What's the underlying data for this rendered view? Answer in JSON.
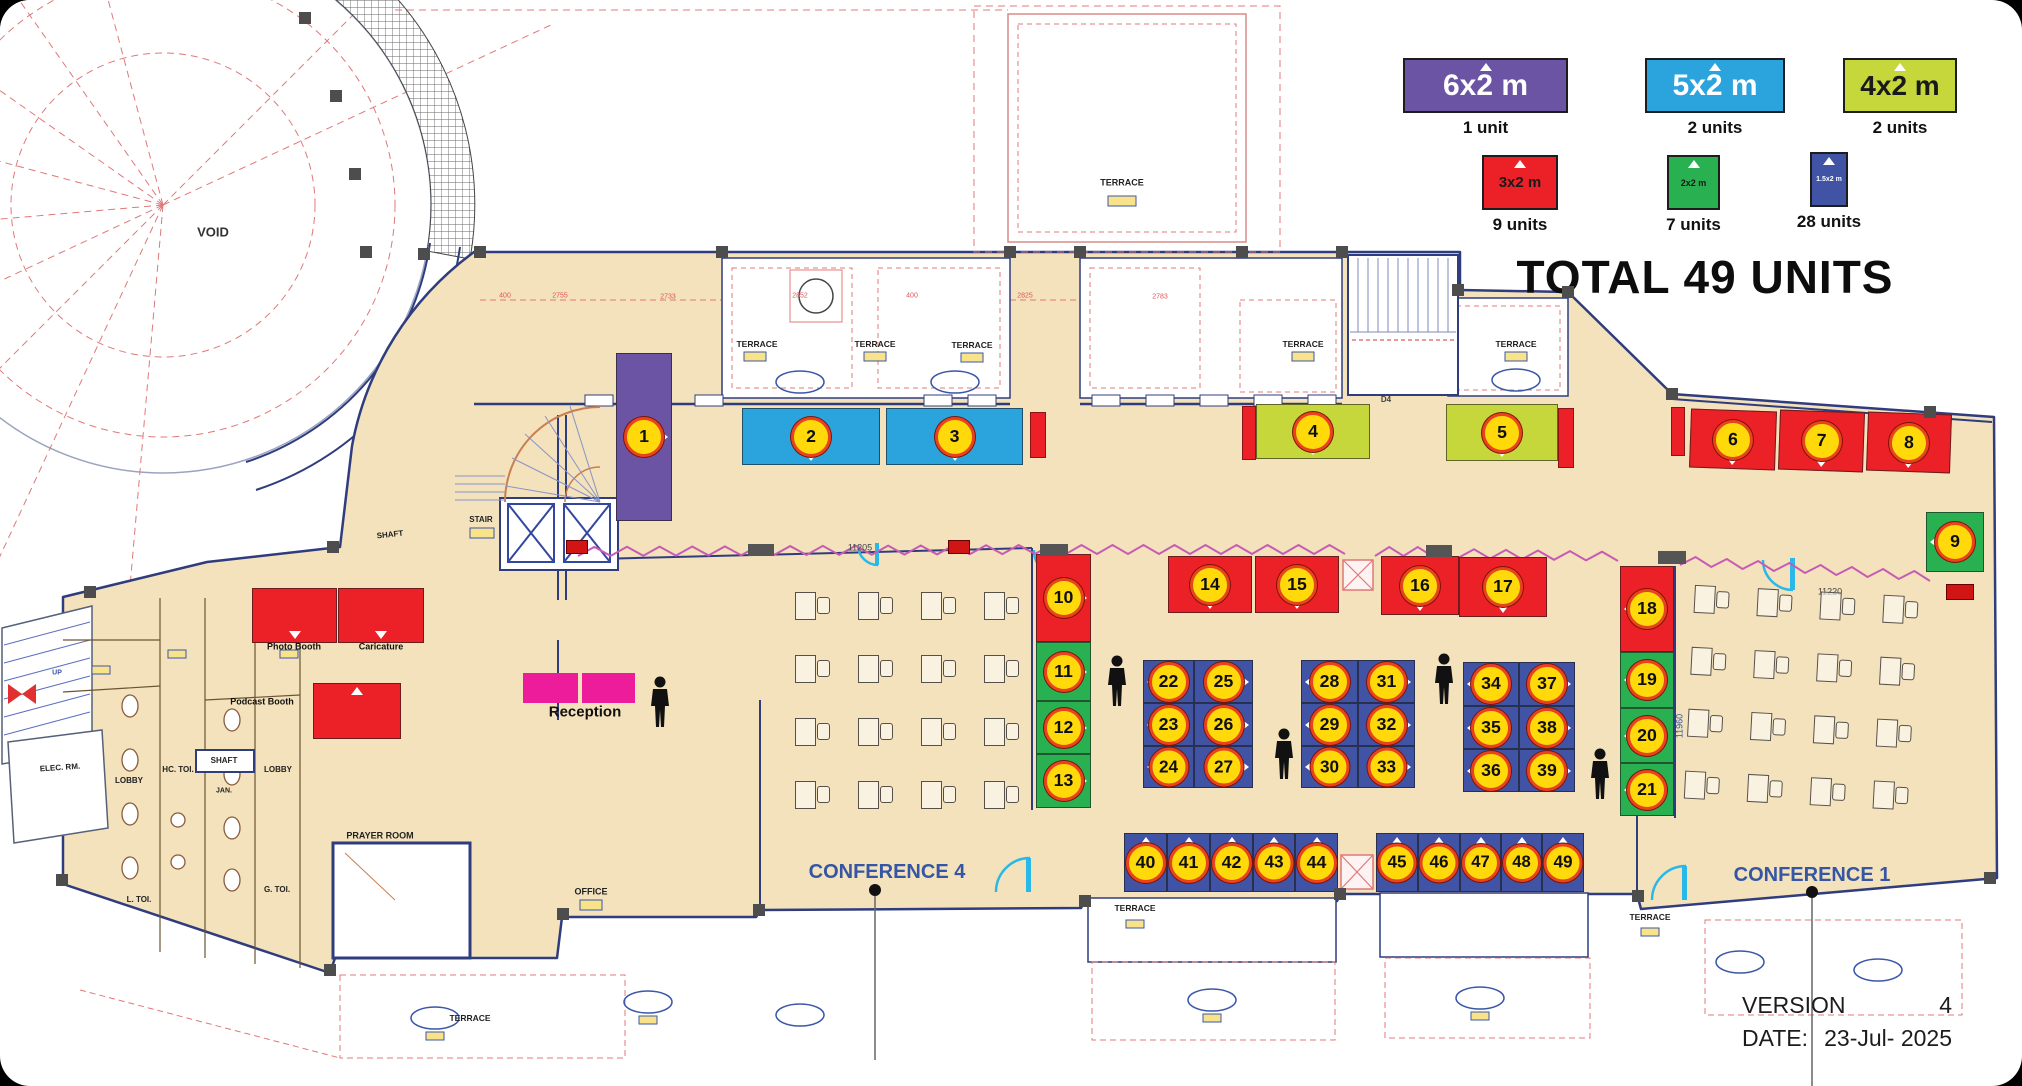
{
  "title": {
    "total": "TOTAL 49 UNITS",
    "version_label": "VERSION",
    "version_value": "4",
    "date_label": "DATE:",
    "date_value": "23-Jul- 2025"
  },
  "legend": {
    "items": [
      {
        "label": "6x2 m",
        "units": "1 unit",
        "color": "#6A54A3",
        "fg": "#ffffff",
        "x": 1403,
        "y": 58,
        "w": 165,
        "h": 55,
        "fs": 30
      },
      {
        "label": "5x2 m",
        "units": "2 units",
        "color": "#2BA4DD",
        "fg": "#ffffff",
        "x": 1645,
        "y": 58,
        "w": 140,
        "h": 55,
        "fs": 30
      },
      {
        "label": "4x2 m",
        "units": "2 units",
        "color": "#C5D73B",
        "fg": "#1a1a1a",
        "x": 1843,
        "y": 58,
        "w": 114,
        "h": 55,
        "fs": 28
      },
      {
        "label": "3x2 m",
        "units": "9 units",
        "color": "#EB2127",
        "fg": "#1a1a1a",
        "x": 1482,
        "y": 155,
        "w": 76,
        "h": 55,
        "fs": 15
      },
      {
        "label": "2x2 m",
        "units": "7 units",
        "color": "#29B050",
        "fg": "#1a1a1a",
        "x": 1667,
        "y": 155,
        "w": 53,
        "h": 55,
        "fs": 9
      },
      {
        "label": "1.5x2 m",
        "units": "28 units",
        "color": "#4053A4",
        "fg": "#ffffff",
        "x": 1810,
        "y": 152,
        "w": 38,
        "h": 55,
        "fs": 7
      }
    ]
  },
  "booths": [
    {
      "n": "1",
      "x": 616,
      "y": 353,
      "w": 56,
      "h": 168,
      "type": "purple",
      "dir": "right"
    },
    {
      "n": "2",
      "x": 742,
      "y": 408,
      "w": 138,
      "h": 57,
      "type": "blue",
      "dir": "down"
    },
    {
      "n": "3",
      "x": 886,
      "y": 408,
      "w": 137,
      "h": 57,
      "type": "blue",
      "dir": "down"
    },
    {
      "n": "4",
      "x": 1256,
      "y": 404,
      "w": 114,
      "h": 55,
      "type": "yg",
      "dir": "down"
    },
    {
      "n": "5",
      "x": 1446,
      "y": 404,
      "w": 112,
      "h": 57,
      "type": "yg",
      "dir": "down"
    },
    {
      "n": "6",
      "x": 1690,
      "y": 410,
      "w": 86,
      "h": 59,
      "type": "red",
      "dir": "down",
      "rot": 2
    },
    {
      "n": "7",
      "x": 1779,
      "y": 411,
      "w": 85,
      "h": 60,
      "type": "red",
      "dir": "down",
      "rot": 2
    },
    {
      "n": "8",
      "x": 1867,
      "y": 413,
      "w": 84,
      "h": 59,
      "type": "red",
      "dir": "down",
      "rot": 2
    },
    {
      "n": "9",
      "x": 1926,
      "y": 512,
      "w": 58,
      "h": 60,
      "type": "green",
      "dir": "left"
    },
    {
      "n": "10",
      "x": 1036,
      "y": 554,
      "w": 55,
      "h": 88,
      "type": "red",
      "dir": "right"
    },
    {
      "n": "11",
      "x": 1036,
      "y": 642,
      "w": 55,
      "h": 59,
      "type": "green",
      "dir": "right"
    },
    {
      "n": "12",
      "x": 1036,
      "y": 701,
      "w": 55,
      "h": 53,
      "type": "green",
      "dir": "right"
    },
    {
      "n": "13",
      "x": 1036,
      "y": 754,
      "w": 55,
      "h": 54,
      "type": "green",
      "dir": "right"
    },
    {
      "n": "14",
      "x": 1168,
      "y": 556,
      "w": 84,
      "h": 57,
      "type": "red",
      "dir": "down"
    },
    {
      "n": "15",
      "x": 1255,
      "y": 556,
      "w": 84,
      "h": 57,
      "type": "red",
      "dir": "down"
    },
    {
      "n": "16",
      "x": 1381,
      "y": 556,
      "w": 78,
      "h": 59,
      "type": "red",
      "dir": "down"
    },
    {
      "n": "17",
      "x": 1459,
      "y": 557,
      "w": 88,
      "h": 60,
      "type": "red",
      "dir": "down"
    },
    {
      "n": "18",
      "x": 1620,
      "y": 566,
      "w": 54,
      "h": 86,
      "type": "red",
      "dir": "left"
    },
    {
      "n": "19",
      "x": 1620,
      "y": 652,
      "w": 54,
      "h": 56,
      "type": "green",
      "dir": "left"
    },
    {
      "n": "20",
      "x": 1620,
      "y": 708,
      "w": 54,
      "h": 55,
      "type": "green",
      "dir": "left"
    },
    {
      "n": "21",
      "x": 1620,
      "y": 763,
      "w": 54,
      "h": 53,
      "type": "green",
      "dir": "left"
    },
    {
      "n": "22",
      "x": 1143,
      "y": 660,
      "w": 51,
      "h": 43,
      "type": "indigo",
      "dir": "left"
    },
    {
      "n": "25",
      "x": 1194,
      "y": 660,
      "w": 59,
      "h": 43,
      "type": "indigo",
      "dir": "right"
    },
    {
      "n": "23",
      "x": 1143,
      "y": 703,
      "w": 51,
      "h": 43,
      "type": "indigo",
      "dir": "left"
    },
    {
      "n": "26",
      "x": 1194,
      "y": 703,
      "w": 59,
      "h": 43,
      "type": "indigo",
      "dir": "right"
    },
    {
      "n": "24",
      "x": 1143,
      "y": 746,
      "w": 51,
      "h": 42,
      "type": "indigo",
      "dir": "left"
    },
    {
      "n": "27",
      "x": 1194,
      "y": 746,
      "w": 59,
      "h": 42,
      "type": "indigo",
      "dir": "right"
    },
    {
      "n": "28",
      "x": 1301,
      "y": 660,
      "w": 57,
      "h": 43,
      "type": "indigo",
      "dir": "left"
    },
    {
      "n": "31",
      "x": 1358,
      "y": 660,
      "w": 57,
      "h": 43,
      "type": "indigo",
      "dir": "right"
    },
    {
      "n": "29",
      "x": 1301,
      "y": 703,
      "w": 57,
      "h": 43,
      "type": "indigo",
      "dir": "left"
    },
    {
      "n": "32",
      "x": 1358,
      "y": 703,
      "w": 57,
      "h": 43,
      "type": "indigo",
      "dir": "right"
    },
    {
      "n": "30",
      "x": 1301,
      "y": 746,
      "w": 57,
      "h": 42,
      "type": "indigo",
      "dir": "left"
    },
    {
      "n": "33",
      "x": 1358,
      "y": 746,
      "w": 57,
      "h": 42,
      "type": "indigo",
      "dir": "right"
    },
    {
      "n": "34",
      "x": 1463,
      "y": 662,
      "w": 56,
      "h": 44,
      "type": "indigo",
      "dir": "left"
    },
    {
      "n": "37",
      "x": 1519,
      "y": 662,
      "w": 56,
      "h": 44,
      "type": "indigo",
      "dir": "right"
    },
    {
      "n": "35",
      "x": 1463,
      "y": 706,
      "w": 56,
      "h": 43,
      "type": "indigo",
      "dir": "left"
    },
    {
      "n": "38",
      "x": 1519,
      "y": 706,
      "w": 56,
      "h": 43,
      "type": "indigo",
      "dir": "right"
    },
    {
      "n": "36",
      "x": 1463,
      "y": 749,
      "w": 56,
      "h": 43,
      "type": "indigo",
      "dir": "left"
    },
    {
      "n": "39",
      "x": 1519,
      "y": 749,
      "w": 56,
      "h": 43,
      "type": "indigo",
      "dir": "right"
    },
    {
      "n": "40",
      "x": 1124,
      "y": 833,
      "w": 43,
      "h": 59,
      "type": "indigo",
      "dir": "up"
    },
    {
      "n": "41",
      "x": 1167,
      "y": 833,
      "w": 43,
      "h": 59,
      "type": "indigo",
      "dir": "up"
    },
    {
      "n": "42",
      "x": 1210,
      "y": 833,
      "w": 43,
      "h": 59,
      "type": "indigo",
      "dir": "up"
    },
    {
      "n": "43",
      "x": 1253,
      "y": 833,
      "w": 42,
      "h": 59,
      "type": "indigo",
      "dir": "up"
    },
    {
      "n": "44",
      "x": 1295,
      "y": 833,
      "w": 43,
      "h": 59,
      "type": "indigo",
      "dir": "up"
    },
    {
      "n": "45",
      "x": 1376,
      "y": 833,
      "w": 42,
      "h": 59,
      "type": "indigo",
      "dir": "up"
    },
    {
      "n": "46",
      "x": 1418,
      "y": 833,
      "w": 42,
      "h": 59,
      "type": "indigo",
      "dir": "up"
    },
    {
      "n": "47",
      "x": 1460,
      "y": 833,
      "w": 41,
      "h": 59,
      "type": "indigo",
      "dir": "up"
    },
    {
      "n": "48",
      "x": 1501,
      "y": 833,
      "w": 41,
      "h": 59,
      "type": "indigo",
      "dir": "up"
    },
    {
      "n": "49",
      "x": 1542,
      "y": 833,
      "w": 42,
      "h": 59,
      "type": "indigo",
      "dir": "up"
    },
    {
      "n": "",
      "x": 252,
      "y": 588,
      "w": 85,
      "h": 55,
      "type": "red",
      "dir": "down"
    },
    {
      "n": "",
      "x": 338,
      "y": 588,
      "w": 86,
      "h": 55,
      "type": "red",
      "dir": "down"
    },
    {
      "n": "",
      "x": 313,
      "y": 683,
      "w": 88,
      "h": 56,
      "type": "red",
      "dir": "up"
    }
  ],
  "map_labels": [
    {
      "name": "void-label",
      "t": "VOID",
      "x": 213,
      "y": 232,
      "fs": 13,
      "c": "#333",
      "fw": 600
    },
    {
      "name": "terrace-label",
      "t": "TERRACE",
      "x": 757,
      "y": 344,
      "fs": 8.5,
      "c": "#222",
      "fw": 600
    },
    {
      "name": "terrace-label",
      "t": "TERRACE",
      "x": 875,
      "y": 344,
      "fs": 8.5,
      "c": "#222",
      "fw": 600
    },
    {
      "name": "terrace-label",
      "t": "TERRACE",
      "x": 972,
      "y": 345,
      "fs": 8.5,
      "c": "#222",
      "fw": 600
    },
    {
      "name": "terrace-label",
      "t": "TERRACE",
      "x": 1303,
      "y": 344,
      "fs": 8.5,
      "c": "#222",
      "fw": 600
    },
    {
      "name": "terrace-label",
      "t": "TERRACE",
      "x": 1516,
      "y": 344,
      "fs": 8.5,
      "c": "#222",
      "fw": 600
    },
    {
      "name": "terrace-label",
      "t": "TERRACE",
      "x": 1122,
      "y": 183,
      "fs": 9,
      "c": "#222",
      "fw": 600
    },
    {
      "name": "terrace-label",
      "t": "TERRACE",
      "x": 1135,
      "y": 908,
      "fs": 8.5,
      "c": "#222",
      "fw": 600
    },
    {
      "name": "terrace-label",
      "t": "TERRACE",
      "x": 1650,
      "y": 917,
      "fs": 8.5,
      "c": "#222",
      "fw": 600
    },
    {
      "name": "terrace-label",
      "t": "TERRACE",
      "x": 470,
      "y": 1018,
      "fs": 8.5,
      "c": "#222",
      "fw": 600
    },
    {
      "name": "stair-label",
      "t": "STAIR",
      "x": 481,
      "y": 520,
      "fs": 8,
      "c": "#222",
      "fw": 600
    },
    {
      "name": "shaft-label",
      "t": "SHAFT",
      "x": 390,
      "y": 535,
      "fs": 8,
      "c": "#222",
      "fw": 600,
      "rot": -6
    },
    {
      "name": "shaft-label",
      "t": "SHAFT",
      "x": 224,
      "y": 761,
      "fs": 8,
      "c": "#222",
      "fw": 600
    },
    {
      "name": "elec-room-label",
      "t": "ELEC. RM.",
      "x": 60,
      "y": 768,
      "fs": 8,
      "c": "#222",
      "fw": 600,
      "rot": -4
    },
    {
      "name": "lobby-label",
      "t": "LOBBY",
      "x": 129,
      "y": 781,
      "fs": 8,
      "c": "#222",
      "fw": 600
    },
    {
      "name": "hc-toilet-label",
      "t": "HC. TOI.",
      "x": 178,
      "y": 770,
      "fs": 8,
      "c": "#222",
      "fw": 600
    },
    {
      "name": "janitor-label",
      "t": "JAN.",
      "x": 224,
      "y": 791,
      "fs": 7,
      "c": "#222",
      "fw": 600
    },
    {
      "name": "lobby-label",
      "t": "LOBBY",
      "x": 278,
      "y": 770,
      "fs": 8,
      "c": "#222",
      "fw": 600
    },
    {
      "name": "ladies-toilet-label",
      "t": "L. TOI.",
      "x": 139,
      "y": 900,
      "fs": 8,
      "c": "#222",
      "fw": 600
    },
    {
      "name": "gents-toilet-label",
      "t": "G. TOI.",
      "x": 277,
      "y": 890,
      "fs": 8,
      "c": "#222",
      "fw": 600
    },
    {
      "name": "up-label",
      "t": "UP",
      "x": 57,
      "y": 673,
      "fs": 7,
      "c": "#3a57a8",
      "fw": 600
    },
    {
      "name": "prayer-room-label",
      "t": "PRAYER ROOM",
      "x": 380,
      "y": 836,
      "fs": 9,
      "c": "#222",
      "fw": 600
    },
    {
      "name": "office-label",
      "t": "OFFICE",
      "x": 591,
      "y": 892,
      "fs": 9,
      "c": "#222",
      "fw": 600
    },
    {
      "name": "conference4-label",
      "t": "CONFERENCE 4",
      "x": 887,
      "y": 872,
      "fs": 20,
      "c": "#3456A4",
      "fw": 600
    },
    {
      "name": "conference1-label",
      "t": "CONFERENCE 1",
      "x": 1812,
      "y": 875,
      "fs": 20,
      "c": "#3456A4",
      "fw": 600
    },
    {
      "name": "photo-booth-label",
      "t": "Photo Booth",
      "x": 294,
      "y": 647,
      "fs": 9,
      "c": "#111",
      "fw": 700
    },
    {
      "name": "caricature-label",
      "t": "Caricature",
      "x": 381,
      "y": 647,
      "fs": 9,
      "c": "#111",
      "fw": 700
    },
    {
      "name": "podcast-booth-label",
      "t": "Podcast Booth",
      "x": 262,
      "y": 702,
      "fs": 9,
      "c": "#111",
      "fw": 700
    },
    {
      "name": "reception-label",
      "t": "Reception",
      "x": 585,
      "y": 712,
      "fs": 15,
      "c": "#111",
      "fw": 700
    },
    {
      "name": "d4-label",
      "t": "D4",
      "x": 1386,
      "y": 400,
      "fs": 8,
      "c": "#444",
      "fw": 600
    },
    {
      "name": "dim-label",
      "t": "11205",
      "x": 860,
      "y": 548,
      "fs": 9,
      "c": "#444",
      "fw": 400
    },
    {
      "name": "dim-label",
      "t": "11220",
      "x": 1830,
      "y": 592,
      "fs": 9,
      "c": "#444",
      "fw": 400
    },
    {
      "name": "dim-label",
      "t": "11960",
      "x": 1680,
      "y": 726,
      "fs": 9,
      "c": "#3456A4",
      "fw": 400,
      "rot": -90
    },
    {
      "name": "dim-red",
      "t": "400",
      "x": 505,
      "y": 296,
      "fs": 7,
      "c": "#e05555",
      "fw": 400
    },
    {
      "name": "dim-red",
      "t": "2755",
      "x": 560,
      "y": 296,
      "fs": 7,
      "c": "#e05555",
      "fw": 400
    },
    {
      "name": "dim-red",
      "t": "2733",
      "x": 668,
      "y": 297,
      "fs": 7,
      "c": "#e05555",
      "fw": 400
    },
    {
      "name": "dim-red",
      "t": "2852",
      "x": 800,
      "y": 296,
      "fs": 7,
      "c": "#e05555",
      "fw": 400
    },
    {
      "name": "dim-red",
      "t": "400",
      "x": 912,
      "y": 296,
      "fs": 7,
      "c": "#e05555",
      "fw": 400
    },
    {
      "name": "dim-red",
      "t": "2825",
      "x": 1025,
      "y": 296,
      "fs": 7,
      "c": "#e05555",
      "fw": 400
    },
    {
      "name": "dim-red",
      "t": "2783",
      "x": 1160,
      "y": 297,
      "fs": 7,
      "c": "#e05555",
      "fw": 400
    }
  ],
  "persons": [
    [
      1105,
      655
    ],
    [
      1272,
      728
    ],
    [
      1432,
      653
    ],
    [
      1588,
      748
    ],
    [
      648,
      676
    ]
  ],
  "colors": {
    "floor": "#F3E2BB",
    "wall": "#2F3C7E",
    "badge": "#FFD90A",
    "badge_ring": "#E8431C",
    "zigzag": "#C75BB4",
    "reception": "#EC1C9B",
    "door": "#29B8E8",
    "red_dash": "#E07878"
  }
}
